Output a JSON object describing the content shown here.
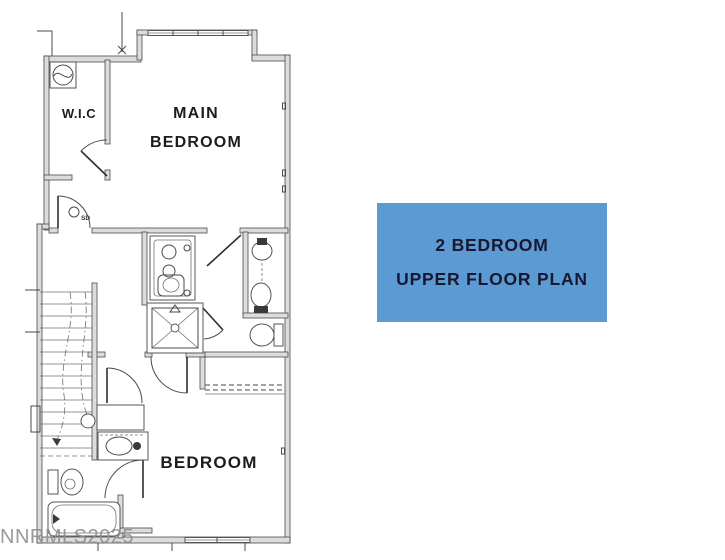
{
  "colors": {
    "page_bg": "#ffffff",
    "panel_bg": "#5b9ad2",
    "panel_text": "#181830",
    "plan_line": "#4a4a4a",
    "wall_fill": "#dcdcdc",
    "label_text": "#1d1d1d",
    "watermark": "#8f8f8f"
  },
  "floor_plan": {
    "rooms": {
      "wic_label": "W.I.C",
      "main_bedroom_line1": "MAIN",
      "main_bedroom_line2": "BEDROOM",
      "bedroom_label": "BEDROOM"
    },
    "symbols": {
      "smoke_detector_label": "SD"
    },
    "watermark": "NNRMLS2025"
  },
  "info_panel": {
    "line1": "2 BEDROOM",
    "line2": "UPPER FLOOR PLAN"
  }
}
